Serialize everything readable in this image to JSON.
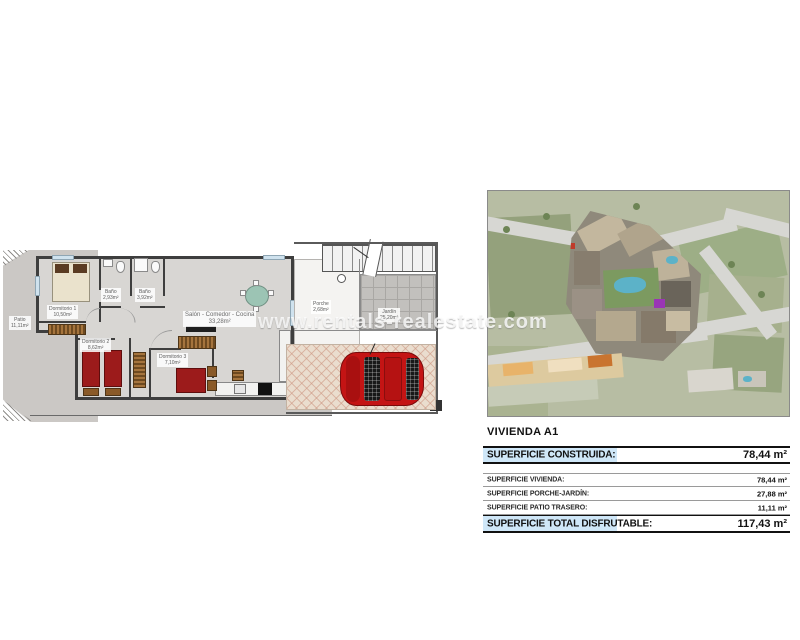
{
  "watermark": "www.rentals-realestate.com",
  "floorplan": {
    "rooms": {
      "patio": {
        "name": "Patio",
        "area": "11,11m²"
      },
      "dormitorio1": {
        "name": "Dormitorio 1",
        "area": "10,50m²"
      },
      "bano1": {
        "name": "Baño",
        "area": "2,93m²"
      },
      "bano2": {
        "name": "Baño",
        "area": "3,92m²"
      },
      "salon": {
        "name": "Salón - Comedor - Cocina",
        "area": "33,28m²"
      },
      "dormitorio2": {
        "name": "Dormitorio 2",
        "area": "8,62m²"
      },
      "dormitorio3": {
        "name": "Dormitorio 3",
        "area": "7,10m²"
      },
      "porche": {
        "name": "Porche",
        "area": "2,68m²"
      },
      "jardin": {
        "name": "Jardín",
        "area": "25,20m²"
      }
    }
  },
  "info": {
    "title": "VIVIENDA A1",
    "header": {
      "label": "SUPERFICIE CONSTRUIDA:",
      "value": "78,44 m²"
    },
    "rows": [
      {
        "label": "SUPERFICIE VIVIENDA:",
        "value": "78,44 m²"
      },
      {
        "label": "SUPERFICIE PORCHE-JARDÍN:",
        "value": "27,88 m²"
      },
      {
        "label": "SUPERFICIE PATIO TRASERO:",
        "value": "11,11 m²"
      }
    ],
    "total": {
      "label": "SUPERFICIE TOTAL DISFRUTABLE:",
      "value": "117,43 m²"
    }
  },
  "colors": {
    "highlight_blue": "#cfe7f8",
    "bed_red": "#9c1b1b",
    "car_red": "#c41414",
    "pool_blue": "#5cb2c8",
    "wall_gray": "#3e3e3e",
    "floor_gray": "#d8d6d3"
  }
}
